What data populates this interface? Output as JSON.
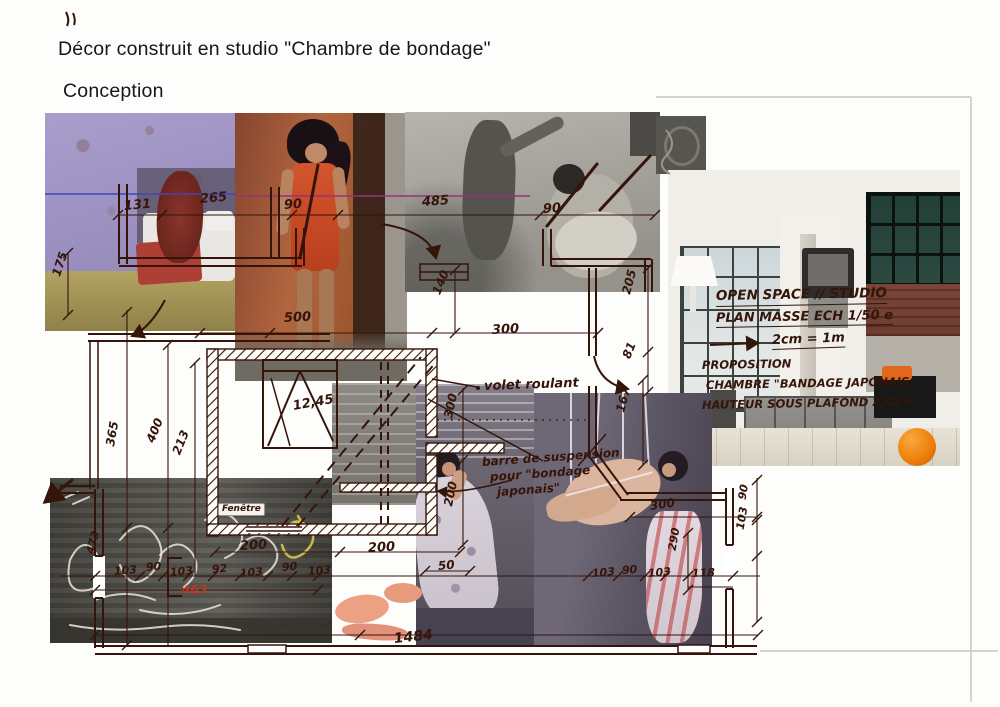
{
  "page": {
    "title": "Décor construit en studio \"Chambre de bondage\"",
    "subtitle": "Conception"
  },
  "colors": {
    "ink": "#35140a",
    "red_dim": "#c03525",
    "blue_line": "#4444b8",
    "magenta_line": "#99307d",
    "paper": "#fdfdfc",
    "ball_orange": "#ee7d08"
  },
  "plan": {
    "notes": [
      {
        "t": "OPEN SPACE // STUDIO",
        "x": 716,
        "y": 290,
        "s": 13.5,
        "r": -1,
        "u": 1
      },
      {
        "t": "PLAN MASSE ECH 1/50 e",
        "x": 716,
        "y": 312,
        "s": 13,
        "r": -1,
        "u": 1
      },
      {
        "t": "2cm = 1m",
        "x": 772,
        "y": 334,
        "s": 13,
        "r": -2,
        "u": 1
      },
      {
        "t": "PROPOSITION",
        "x": 702,
        "y": 360,
        "s": 11.5,
        "r": -1
      },
      {
        "t": "CHAMBRE \"BANDAGE JAPONAIS",
        "x": 706,
        "y": 380,
        "s": 11.5,
        "r": -1
      },
      {
        "t": "HAUTEUR SOUS PLAFOND 2,48 m",
        "x": 702,
        "y": 400,
        "s": 11.5,
        "r": -1
      }
    ],
    "annotations": [
      {
        "t": "volet roulant",
        "x": 484,
        "y": 380,
        "s": 13,
        "r": -2
      },
      {
        "t": "barre de suspension",
        "x": 482,
        "y": 456,
        "s": 12,
        "r": -4
      },
      {
        "t": "pour \"bondage",
        "x": 490,
        "y": 471,
        "s": 12,
        "r": -4
      },
      {
        "t": "japonais\"",
        "x": 497,
        "y": 486,
        "s": 12,
        "r": -4
      },
      {
        "t": "Fenêtre",
        "x": 218,
        "y": 503,
        "s": 9,
        "chip": 1
      }
    ],
    "dimensions": [
      {
        "t": "131",
        "x": 124,
        "y": 200,
        "r": -5,
        "s": 13
      },
      {
        "t": "265",
        "x": 200,
        "y": 193,
        "r": -5,
        "s": 13
      },
      {
        "t": "90",
        "x": 284,
        "y": 199,
        "r": -4,
        "s": 13
      },
      {
        "t": "485",
        "x": 422,
        "y": 196,
        "r": -4,
        "s": 13
      },
      {
        "t": "90",
        "x": 543,
        "y": 203,
        "r": -4,
        "s": 13
      },
      {
        "t": "175",
        "x": 56,
        "y": 270,
        "r": -72,
        "s": 12
      },
      {
        "t": "500",
        "x": 284,
        "y": 312,
        "r": -3,
        "s": 13
      },
      {
        "t": "140",
        "x": 436,
        "y": 288,
        "r": -68,
        "s": 12
      },
      {
        "t": "300",
        "x": 492,
        "y": 324,
        "r": -3,
        "s": 13
      },
      {
        "t": "205",
        "x": 626,
        "y": 288,
        "r": -75,
        "s": 12
      },
      {
        "t": "81",
        "x": 626,
        "y": 352,
        "r": -68,
        "s": 12
      },
      {
        "t": "167",
        "x": 620,
        "y": 406,
        "r": -75,
        "s": 12
      },
      {
        "t": "12,45",
        "x": 293,
        "y": 400,
        "r": -10,
        "s": 13
      },
      {
        "t": "365",
        "x": 110,
        "y": 440,
        "r": -80,
        "s": 12
      },
      {
        "t": "400",
        "x": 150,
        "y": 436,
        "r": -68,
        "s": 12
      },
      {
        "t": "213",
        "x": 176,
        "y": 448,
        "r": -68,
        "s": 12
      },
      {
        "t": "300",
        "x": 448,
        "y": 412,
        "r": -78,
        "s": 12
      },
      {
        "t": "200",
        "x": 448,
        "y": 500,
        "r": -78,
        "s": 12
      },
      {
        "t": "200",
        "x": 240,
        "y": 540,
        "r": -3,
        "s": 13
      },
      {
        "t": "200",
        "x": 368,
        "y": 542,
        "r": -3,
        "s": 13
      },
      {
        "t": "50",
        "x": 438,
        "y": 560,
        "r": -5,
        "s": 12
      },
      {
        "t": "473",
        "x": 90,
        "y": 548,
        "r": -75,
        "s": 11
      },
      {
        "t": "103",
        "x": 114,
        "y": 566,
        "r": -5,
        "s": 11
      },
      {
        "t": "90",
        "x": 146,
        "y": 562,
        "r": -5,
        "s": 11
      },
      {
        "t": "103",
        "x": 170,
        "y": 567,
        "r": -5,
        "s": 11
      },
      {
        "t": "92",
        "x": 212,
        "y": 564,
        "r": -5,
        "s": 11
      },
      {
        "t": "103",
        "x": 240,
        "y": 568,
        "r": -5,
        "s": 11
      },
      {
        "t": "90",
        "x": 282,
        "y": 562,
        "r": -5,
        "s": 11
      },
      {
        "t": "103",
        "x": 308,
        "y": 566,
        "r": -5,
        "s": 11
      },
      {
        "t": "463",
        "x": 182,
        "y": 584,
        "r": -2,
        "s": 12,
        "c": "#c03525"
      },
      {
        "t": "103",
        "x": 592,
        "y": 568,
        "r": -5,
        "s": 11
      },
      {
        "t": "90",
        "x": 622,
        "y": 565,
        "r": -5,
        "s": 11
      },
      {
        "t": "103",
        "x": 648,
        "y": 568,
        "r": -5,
        "s": 11
      },
      {
        "t": "290",
        "x": 672,
        "y": 545,
        "r": -80,
        "s": 11
      },
      {
        "t": "118",
        "x": 692,
        "y": 568,
        "r": -3,
        "s": 11
      },
      {
        "t": "300",
        "x": 650,
        "y": 500,
        "r": -8,
        "s": 12
      },
      {
        "t": "90",
        "x": 742,
        "y": 494,
        "r": -80,
        "s": 11
      },
      {
        "t": "103",
        "x": 740,
        "y": 524,
        "r": -80,
        "s": 11
      },
      {
        "t": "1484",
        "x": 394,
        "y": 632,
        "r": -6,
        "s": 14
      }
    ]
  }
}
